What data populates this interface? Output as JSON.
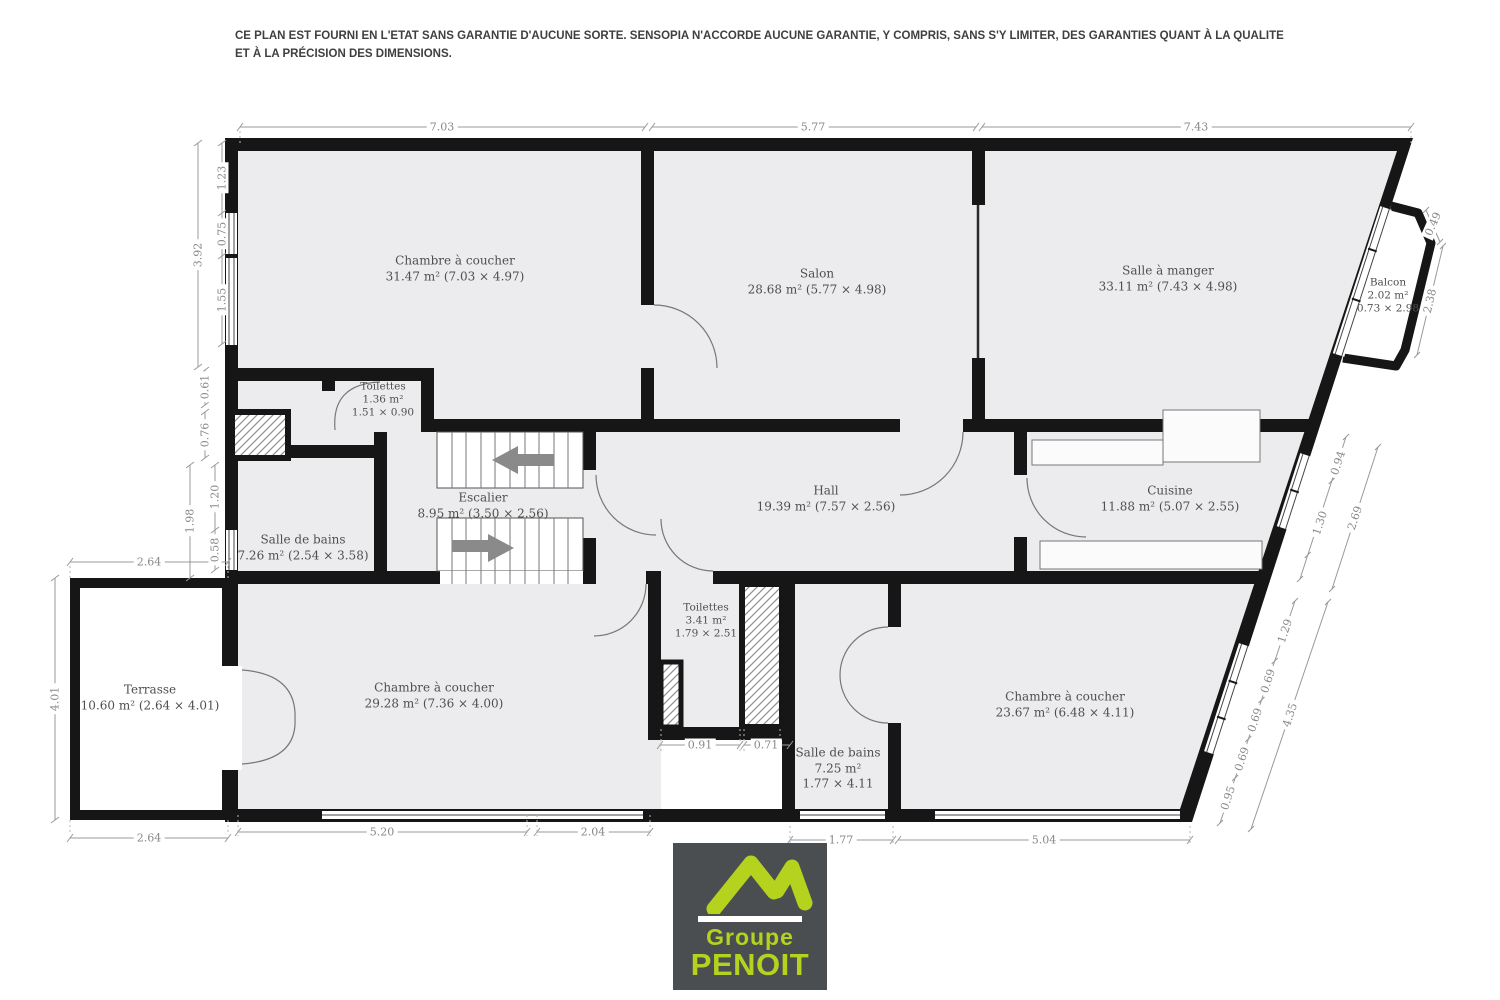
{
  "disclaimer": "CE PLAN EST FOURNI EN L'ETAT SANS GARANTIE D'AUCUNE SORTE. SENSOPIA N'ACCORDE AUCUNE GARANTIE, Y COMPRIS, SANS S'Y LIMITER, DES GARANTIES QUANT À LA QUALITE ET À LA PRÉCISION DES DIMENSIONS.",
  "rooms": {
    "chambre_tl": {
      "name": "Chambre à coucher",
      "details": "31.47 m² (7.03 × 4.97)"
    },
    "salon": {
      "name": "Salon",
      "details": "28.68 m² (5.77 × 4.98)"
    },
    "salle_a_manger": {
      "name": "Salle à manger",
      "details": "33.11 m² (7.43 × 4.98)"
    },
    "balcon": {
      "name": "Balcon",
      "area": "2.02 m²",
      "size": "0.73 × 2.98"
    },
    "toilettes_haut": {
      "name": "Toilettes",
      "area": "1.36 m²",
      "size": "1.51 × 0.90"
    },
    "escalier": {
      "name": "Escalier",
      "details": "8.95 m² (3.50 × 2.56)"
    },
    "salle_de_bains_gauche": {
      "name": "Salle de bains",
      "details": "7.26 m² (2.54 × 3.58)"
    },
    "hall": {
      "name": "Hall",
      "details": "19.39 m² (7.57 × 2.56)"
    },
    "cuisine": {
      "name": "Cuisine",
      "details": "11.88 m² (5.07 × 2.55)"
    },
    "terrasse": {
      "name": "Terrasse",
      "details": "10.60 m² (2.64 × 4.01)"
    },
    "chambre_bl": {
      "name": "Chambre à coucher",
      "details": "29.28 m² (7.36 × 4.00)"
    },
    "toilettes_bas": {
      "name": "Toilettes",
      "area": "3.41 m²",
      "size": "1.79 × 2.51"
    },
    "salle_de_bains_bas": {
      "name": "Salle de bains",
      "area": "7.25 m²",
      "size": "1.77 × 4.11"
    },
    "chambre_br": {
      "name": "Chambre à coucher",
      "details": "23.67 m² (6.48 × 4.11)"
    }
  },
  "dimensions": {
    "top": [
      "7.03",
      "5.77",
      "7.43"
    ],
    "left": [
      "3.92",
      "1.23",
      "0.75",
      "1.55",
      "0.61",
      "0.76",
      "1.98",
      "1.20",
      "0.58"
    ],
    "terrasse": [
      "2.64",
      "4.01",
      "2.64"
    ],
    "bottom": [
      "5.20",
      "2.04",
      "0.91",
      "0.71",
      "1.77",
      "5.04"
    ],
    "right": [
      "0.49",
      "2.38",
      "0.94",
      "1.30",
      "2.69",
      "1.29",
      "0.69",
      "0.69",
      "0.69",
      "0.95",
      "4.35"
    ]
  },
  "logo": {
    "line1": "Groupe",
    "line2": "PENOIT"
  },
  "colors": {
    "floor": "#ececee",
    "wall": "#161616",
    "accent_green": "#b5d21e",
    "logo_bg": "#4a4e50",
    "dim": "#8a8a8a"
  }
}
